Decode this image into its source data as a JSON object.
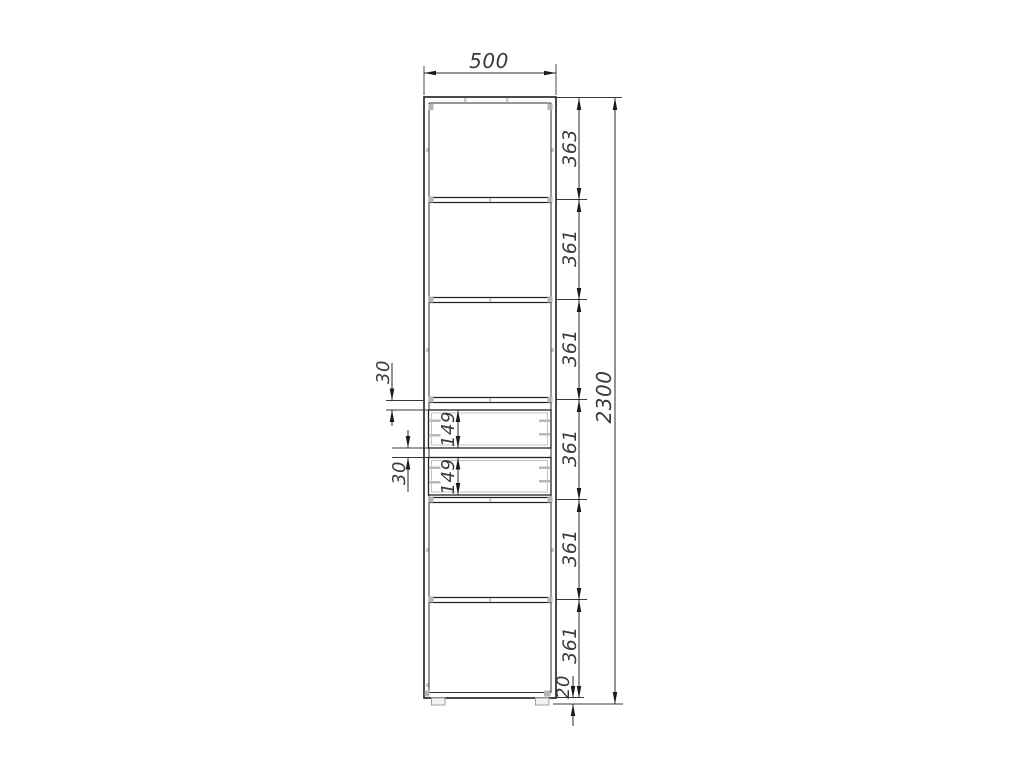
{
  "drawing": {
    "dims": {
      "width": "500",
      "total_height": "2300",
      "sections": [
        "363",
        "361",
        "361",
        "361",
        "361",
        "361"
      ],
      "plinth": "20",
      "gaps": [
        "30",
        "30"
      ],
      "drawer_heights": [
        "149",
        "149"
      ]
    },
    "colors": {
      "background": "#ffffff",
      "outline": "#1d1d1d",
      "dimension_lines": "#2a2a2a",
      "dimension_text": "#3a3a3a",
      "hardware_gray": "#b5b5b5"
    }
  }
}
